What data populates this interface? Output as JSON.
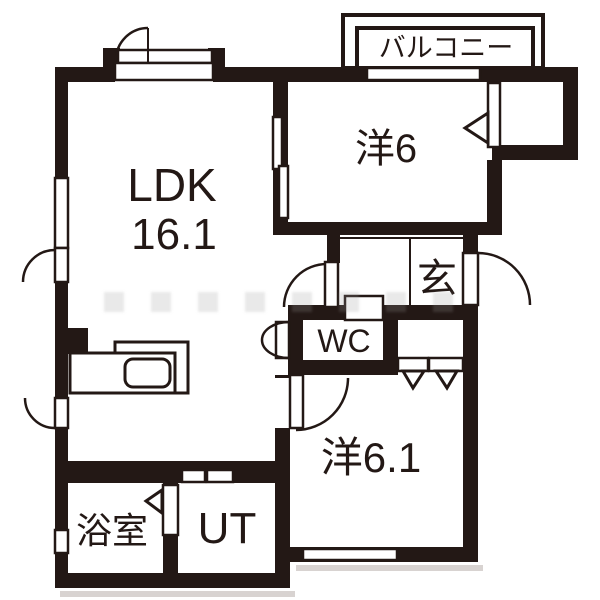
{
  "colors": {
    "ink": "#231815",
    "background": "#ffffff",
    "shadow": "#d8d3d1",
    "watermark": "#9b9b9b"
  },
  "rooms": {
    "balcony": {
      "label": "バルコニー"
    },
    "bedroom1": {
      "label": "洋6"
    },
    "ldk": {
      "label": "LDK",
      "area": "16.1"
    },
    "entrance": {
      "label": "玄"
    },
    "toilet": {
      "label": "WC"
    },
    "bedroom2": {
      "label": "洋6.1"
    },
    "bathroom": {
      "label": "浴室"
    },
    "utility": {
      "label": "UT"
    }
  }
}
